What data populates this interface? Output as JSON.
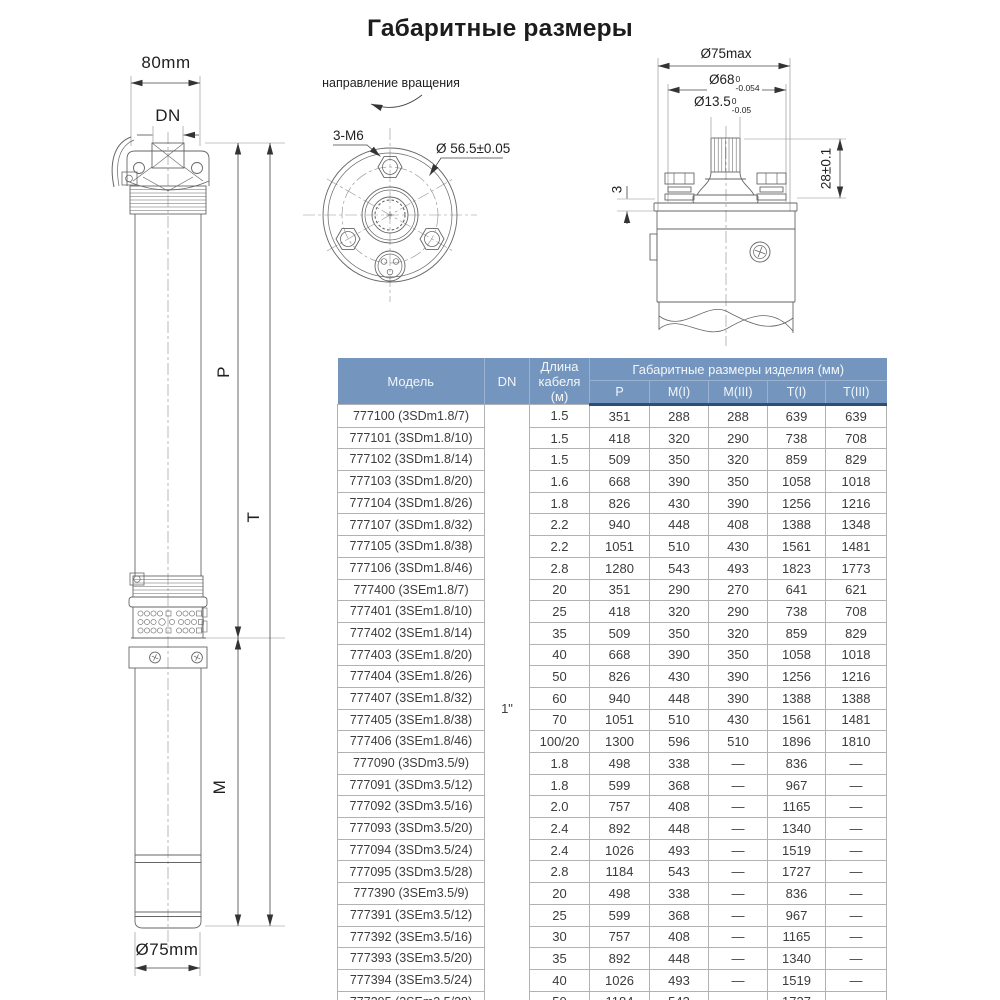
{
  "title": "Габаритные размеры",
  "colors": {
    "table_header_bg": "#7495be",
    "table_header_border": "#2f4e76",
    "table_grid": "#b2b2b2",
    "drawing_line": "#666666"
  },
  "left_view": {
    "width": "80mm",
    "outlet": "DN",
    "p": "P",
    "t": "T",
    "m": "M",
    "diameter": "Ø75mm"
  },
  "rotation_view": {
    "caption": "направление вращения",
    "bolts": "3-М6",
    "bolt_circle": "Ø 56.5±0.05"
  },
  "shaft_view": {
    "d75": "Ø75max",
    "d68": {
      "base": "Ø68",
      "sup": "0",
      "sub": "-0.054"
    },
    "d135": {
      "base": "Ø13.5",
      "sup": "0",
      "sub": "-0.05"
    },
    "height": "28±0.1",
    "gap": "3"
  },
  "table": {
    "headers": {
      "model": "Модель",
      "dn": "DN",
      "cable": "Длина кабеля (м)",
      "group": "Габаритные размеры изделия (мм)",
      "sub": [
        "P",
        "M(I)",
        "M(III)",
        "T(I)",
        "T(III)"
      ]
    },
    "dn_value": "1\"",
    "rows": [
      {
        "model": "777100 (3SDm1.8/7)",
        "cable": "1.5",
        "p": "351",
        "mi": "288",
        "miii": "288",
        "ti": "639",
        "tiii": "639"
      },
      {
        "model": "777101 (3SDm1.8/10)",
        "cable": "1.5",
        "p": "418",
        "mi": "320",
        "miii": "290",
        "ti": "738",
        "tiii": "708"
      },
      {
        "model": "777102 (3SDm1.8/14)",
        "cable": "1.5",
        "p": "509",
        "mi": "350",
        "miii": "320",
        "ti": "859",
        "tiii": "829"
      },
      {
        "model": "777103 (3SDm1.8/20)",
        "cable": "1.6",
        "p": "668",
        "mi": "390",
        "miii": "350",
        "ti": "1058",
        "tiii": "1018"
      },
      {
        "model": "777104 (3SDm1.8/26)",
        "cable": "1.8",
        "p": "826",
        "mi": "430",
        "miii": "390",
        "ti": "1256",
        "tiii": "1216"
      },
      {
        "model": "777107 (3SDm1.8/32)",
        "cable": "2.2",
        "p": "940",
        "mi": "448",
        "miii": "408",
        "ti": "1388",
        "tiii": "1348"
      },
      {
        "model": "777105 (3SDm1.8/38)",
        "cable": "2.2",
        "p": "1051",
        "mi": "510",
        "miii": "430",
        "ti": "1561",
        "tiii": "1481"
      },
      {
        "model": "777106 (3SDm1.8/46)",
        "cable": "2.8",
        "p": "1280",
        "mi": "543",
        "miii": "493",
        "ti": "1823",
        "tiii": "1773"
      },
      {
        "model": "777400 (3SEm1.8/7)",
        "cable": "20",
        "p": "351",
        "mi": "290",
        "miii": "270",
        "ti": "641",
        "tiii": "621"
      },
      {
        "model": "777401 (3SEm1.8/10)",
        "cable": "25",
        "p": "418",
        "mi": "320",
        "miii": "290",
        "ti": "738",
        "tiii": "708"
      },
      {
        "model": "777402 (3SEm1.8/14)",
        "cable": "35",
        "p": "509",
        "mi": "350",
        "miii": "320",
        "ti": "859",
        "tiii": "829"
      },
      {
        "model": "777403 (3SEm1.8/20)",
        "cable": "40",
        "p": "668",
        "mi": "390",
        "miii": "350",
        "ti": "1058",
        "tiii": "1018"
      },
      {
        "model": "777404 (3SEm1.8/26)",
        "cable": "50",
        "p": "826",
        "mi": "430",
        "miii": "390",
        "ti": "1256",
        "tiii": "1216"
      },
      {
        "model": "777407 (3SEm1.8/32)",
        "cable": "60",
        "p": "940",
        "mi": "448",
        "miii": "390",
        "ti": "1388",
        "tiii": "1388"
      },
      {
        "model": "777405 (3SEm1.8/38)",
        "cable": "70",
        "p": "1051",
        "mi": "510",
        "miii": "430",
        "ti": "1561",
        "tiii": "1481"
      },
      {
        "model": "777406 (3SEm1.8/46)",
        "cable": "100/20",
        "p": "1300",
        "mi": "596",
        "miii": "510",
        "ti": "1896",
        "tiii": "1810"
      },
      {
        "model": "777090 (3SDm3.5/9)",
        "cable": "1.8",
        "p": "498",
        "mi": "338",
        "miii": "—",
        "ti": "836",
        "tiii": "—"
      },
      {
        "model": "777091 (3SDm3.5/12)",
        "cable": "1.8",
        "p": "599",
        "mi": "368",
        "miii": "—",
        "ti": "967",
        "tiii": "—"
      },
      {
        "model": "777092 (3SDm3.5/16)",
        "cable": "2.0",
        "p": "757",
        "mi": "408",
        "miii": "—",
        "ti": "1165",
        "tiii": "—"
      },
      {
        "model": "777093 (3SDm3.5/20)",
        "cable": "2.4",
        "p": "892",
        "mi": "448",
        "miii": "—",
        "ti": "1340",
        "tiii": "—"
      },
      {
        "model": "777094 (3SDm3.5/24)",
        "cable": "2.4",
        "p": "1026",
        "mi": "493",
        "miii": "—",
        "ti": "1519",
        "tiii": "—"
      },
      {
        "model": "777095 (3SDm3.5/28)",
        "cable": "2.8",
        "p": "1184",
        "mi": "543",
        "miii": "—",
        "ti": "1727",
        "tiii": "—"
      },
      {
        "model": "777390 (3SEm3.5/9)",
        "cable": "20",
        "p": "498",
        "mi": "338",
        "miii": "—",
        "ti": "836",
        "tiii": "—"
      },
      {
        "model": "777391 (3SEm3.5/12)",
        "cable": "25",
        "p": "599",
        "mi": "368",
        "miii": "—",
        "ti": "967",
        "tiii": "—"
      },
      {
        "model": "777392 (3SEm3.5/16)",
        "cable": "30",
        "p": "757",
        "mi": "408",
        "miii": "—",
        "ti": "1165",
        "tiii": "—"
      },
      {
        "model": "777393 (3SEm3.5/20)",
        "cable": "35",
        "p": "892",
        "mi": "448",
        "miii": "—",
        "ti": "1340",
        "tiii": "—"
      },
      {
        "model": "777394 (3SEm3.5/24)",
        "cable": "40",
        "p": "1026",
        "mi": "493",
        "miii": "—",
        "ti": "1519",
        "tiii": "—"
      },
      {
        "model": "777395 (3SEm3.5/28)",
        "cable": "50",
        "p": "1184",
        "mi": "543",
        "miii": "—",
        "ti": "1727",
        "tiii": "—"
      }
    ]
  }
}
